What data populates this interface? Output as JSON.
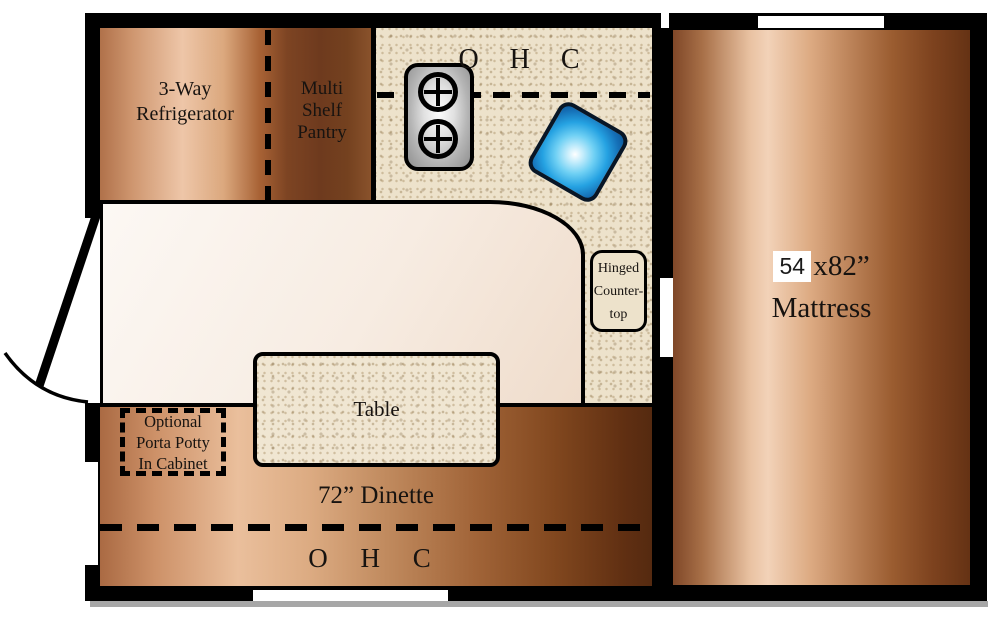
{
  "diagram": {
    "type": "rv-floor-plan",
    "kitchen": {
      "refrigerator_label": [
        "3-Way",
        "Refrigerator"
      ],
      "pantry_label": [
        "Multi",
        "Shelf",
        "Pantry"
      ],
      "overhead_cabinet_label": "O H C",
      "hinged_countertop_label": [
        "Hinged",
        "Counter-",
        "top"
      ]
    },
    "dinette": {
      "table_label": "Table",
      "porta_potty_label": [
        "Optional",
        "Porta Potty",
        "In Cabinet"
      ],
      "dinette_label": "72” Dinette",
      "overhead_cabinet_label": "O H C"
    },
    "bed": {
      "size_value": "54",
      "size_suffix": "x82”",
      "mattress_label": "Mattress"
    },
    "colors": {
      "wall": "#000000",
      "counter_base": "#ede2cb",
      "sink_blue": "#25a2e2",
      "wood_light": "#eec6a8",
      "wood_dark": "#602f12",
      "floor_cream": "#f8f1ea",
      "stove_gray": "#b5b5b5"
    }
  }
}
